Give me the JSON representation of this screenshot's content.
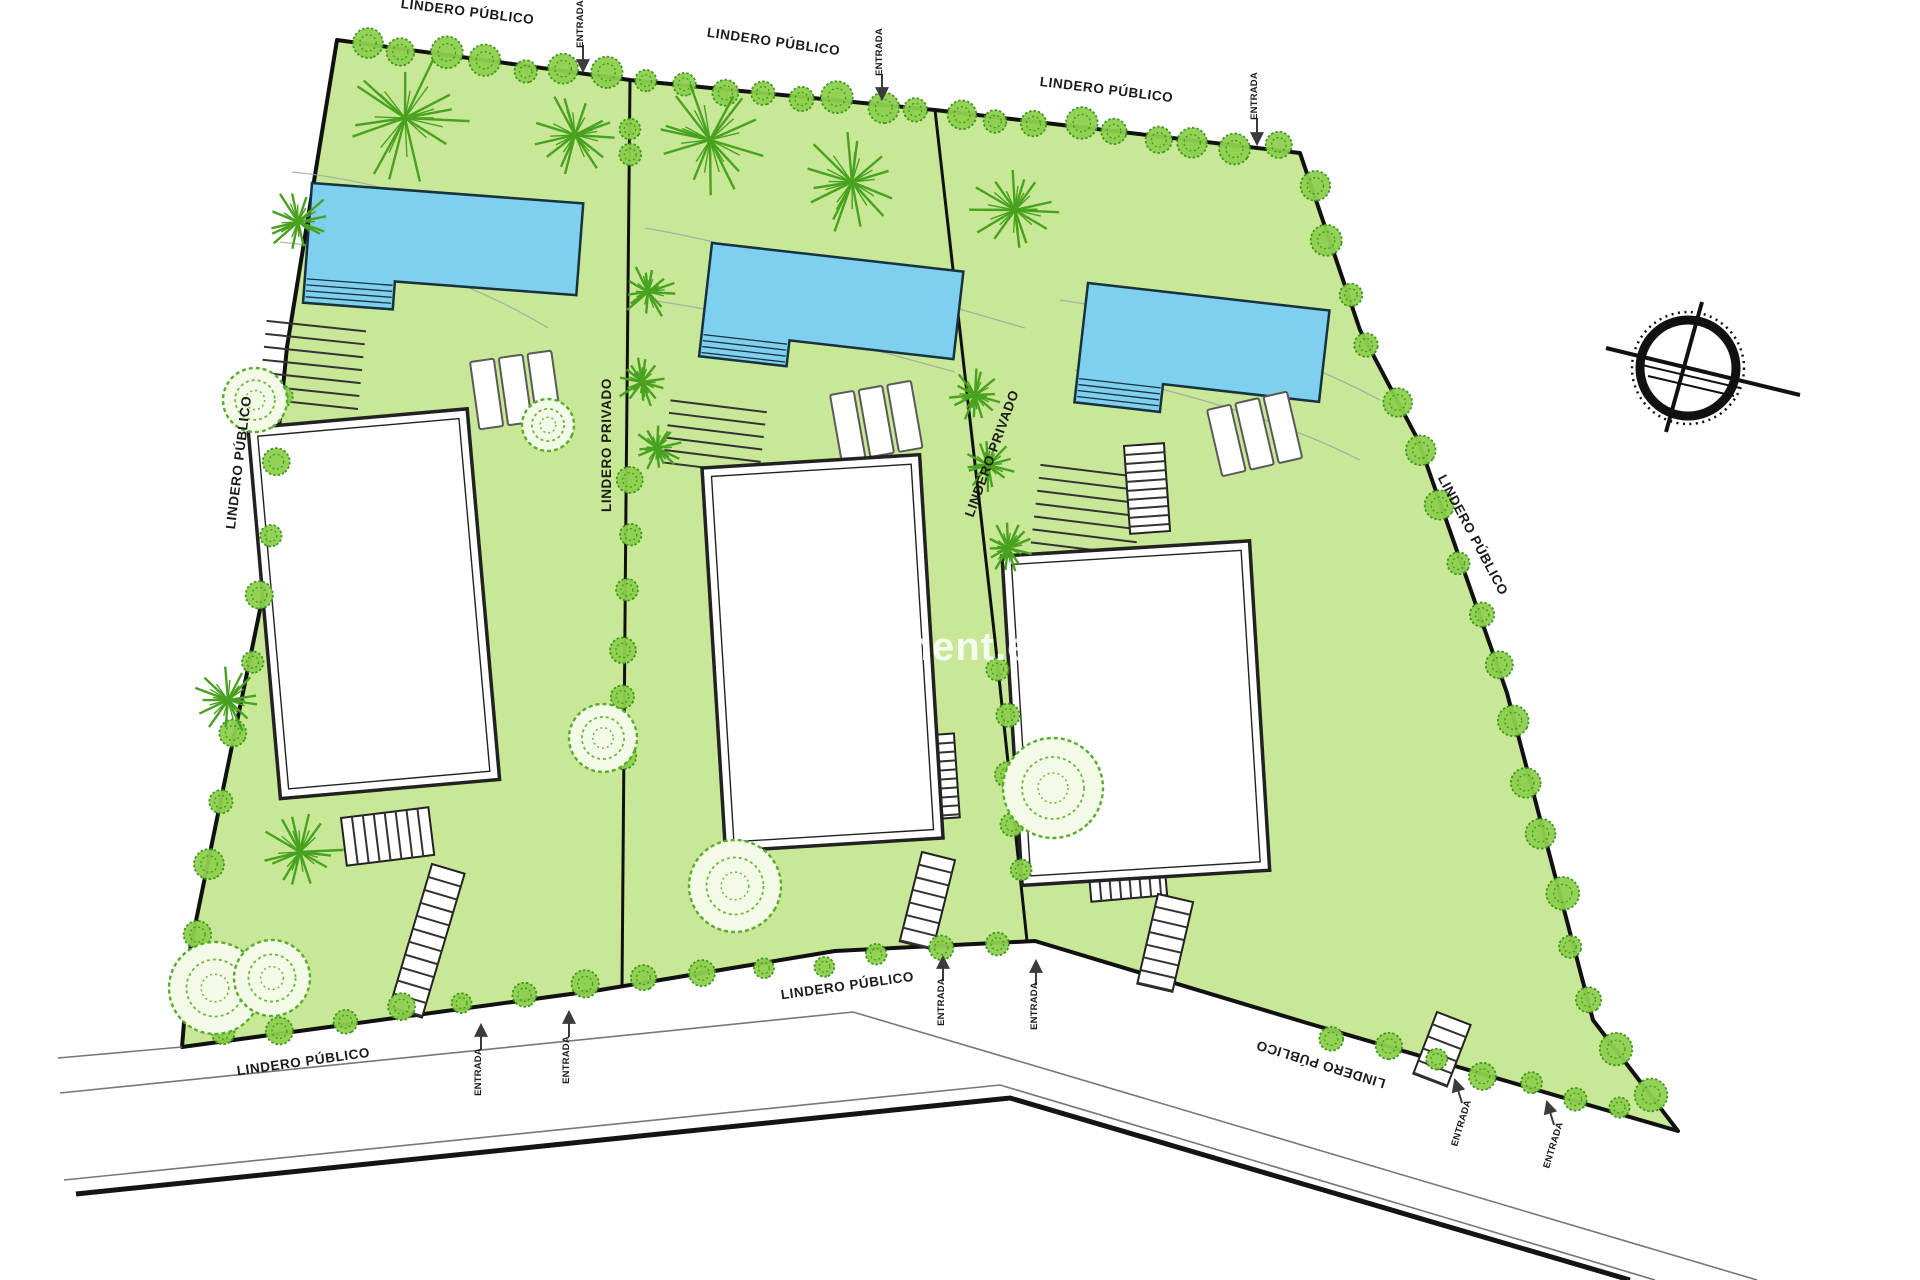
{
  "plan": {
    "labels": {
      "public_boundary": "LINDERO PÚBLICO",
      "private_boundary": "LINDERO PRIVADO",
      "entrance": "ENTRADA"
    },
    "watermark": "oment.es",
    "colors": {
      "grass": "#c9e897",
      "pool_water": "#7fd0ee",
      "tree_fill": "#8ed04e",
      "tree_stroke": "#38941b",
      "boundary_line": "#111111",
      "road_line": "#777777"
    }
  }
}
